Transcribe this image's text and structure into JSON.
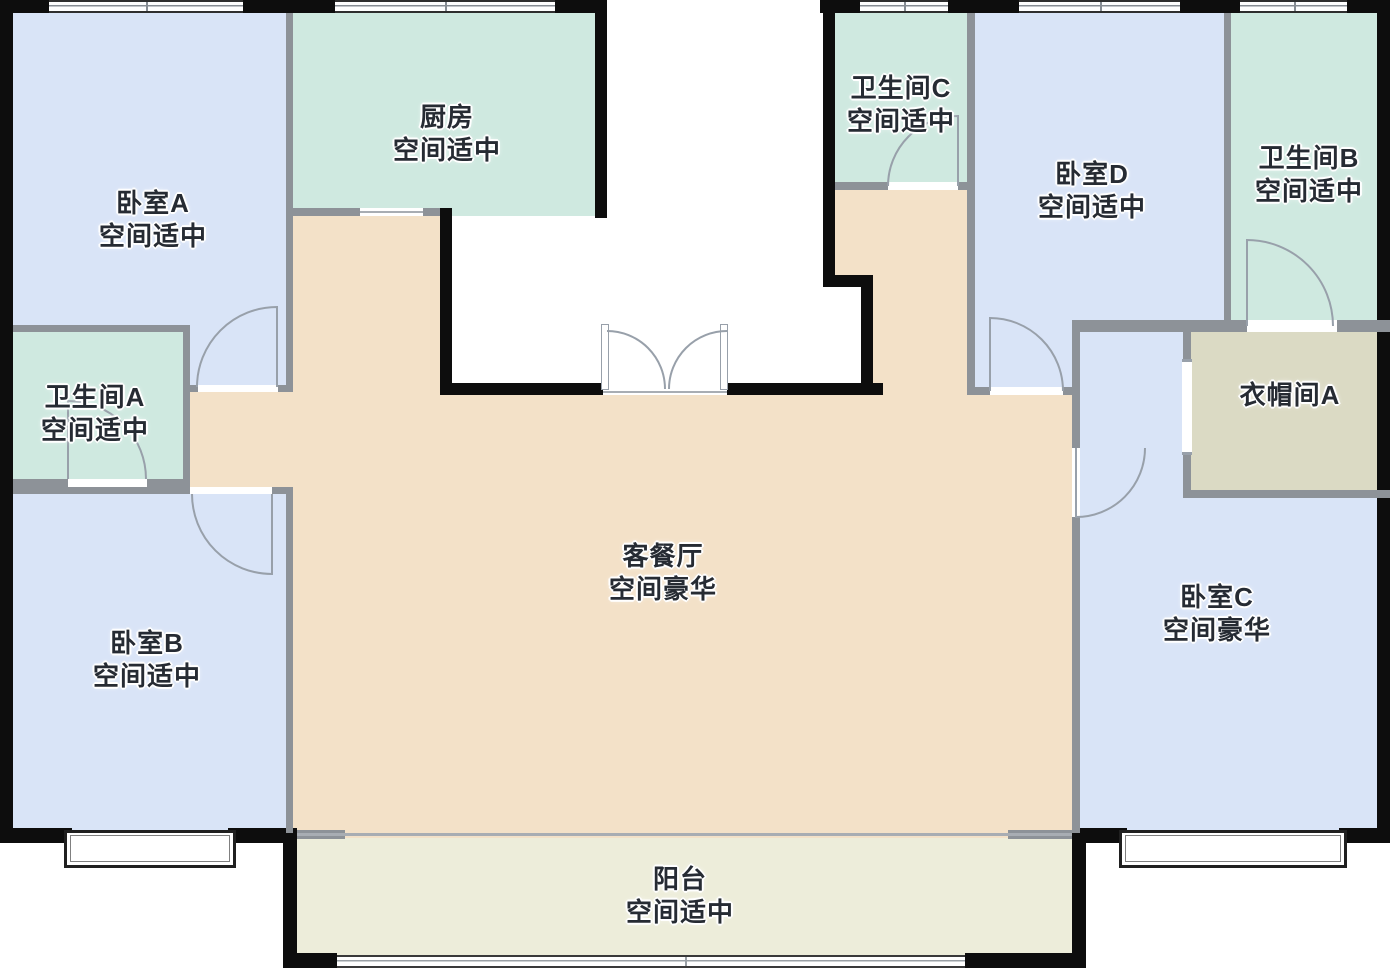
{
  "floorplan": {
    "title": "apartment-floor-plan",
    "colors": {
      "bedroom": "#d9e4f7",
      "wet": "#cfe9e0",
      "living": "#f3e1c8",
      "balcony": "#ededda",
      "closet": "#dbdac4",
      "wall_black": "#0d0d0d",
      "wall_gray": "#8d9298",
      "door_stroke": "#98a0aa",
      "label_text": "#262b33"
    },
    "rooms": [
      {
        "id": "bedroom-a",
        "lines": [
          "卧室A",
          "空间适中"
        ],
        "fill": "bedroom",
        "label": {
          "x": 153,
          "y": 187
        },
        "rects": [
          [
            13,
            13,
            280,
            379
          ]
        ]
      },
      {
        "id": "kitchen",
        "lines": [
          "厨房",
          "空间适中"
        ],
        "fill": "wet",
        "label": {
          "x": 447,
          "y": 101
        },
        "rects": [
          [
            293,
            13,
            314,
            203
          ]
        ]
      },
      {
        "id": "bath-a",
        "lines": [
          "卫生间A",
          "空间适中"
        ],
        "fill": "wet",
        "label": {
          "x": 95,
          "y": 381
        },
        "rects": [
          [
            13,
            325,
            177,
            162
          ]
        ]
      },
      {
        "id": "bedroom-b",
        "lines": [
          "卧室B",
          "空间适中"
        ],
        "fill": "bedroom",
        "label": {
          "x": 147,
          "y": 627
        },
        "rects": [
          [
            13,
            487,
            280,
            343
          ]
        ]
      },
      {
        "id": "living-dining",
        "lines": [
          "客餐厅",
          "空间豪华"
        ],
        "fill": "living",
        "label": {
          "x": 663,
          "y": 540
        },
        "rects": [
          [
            190,
            392,
            103,
            95
          ],
          [
            293,
            216,
            147,
            179
          ],
          [
            293,
            395,
            780,
            443
          ],
          [
            835,
            188,
            135,
            99
          ],
          [
            861,
            287,
            109,
            108
          ]
        ]
      },
      {
        "id": "balcony",
        "lines": [
          "阳台",
          "空间适中"
        ],
        "fill": "balcony",
        "label": {
          "x": 680,
          "y": 863
        },
        "rects": [
          [
            297,
            838,
            776,
            120
          ]
        ]
      },
      {
        "id": "bath-c",
        "lines": [
          "卫生间C",
          "空间适中"
        ],
        "fill": "wet",
        "label": {
          "x": 901,
          "y": 72
        },
        "rects": [
          [
            835,
            13,
            140,
            177
          ]
        ]
      },
      {
        "id": "bedroom-d",
        "lines": [
          "卧室D",
          "空间适中"
        ],
        "fill": "bedroom",
        "label": {
          "x": 1092,
          "y": 158
        },
        "rects": [
          [
            970,
            13,
            260,
            382
          ]
        ]
      },
      {
        "id": "bath-b",
        "lines": [
          "卫生间B",
          "空间适中"
        ],
        "fill": "wet",
        "label": {
          "x": 1309,
          "y": 142
        },
        "rects": [
          [
            1224,
            13,
            166,
            319
          ]
        ]
      },
      {
        "id": "bedroom-c",
        "lines": [
          "卧室C",
          "空间豪华"
        ],
        "fill": "bedroom",
        "label": {
          "x": 1217,
          "y": 581
        },
        "rects": [
          [
            1072,
            323,
            318,
            520
          ]
        ]
      },
      {
        "id": "closet-a",
        "lines": [
          "衣帽间A"
        ],
        "fill": "closet",
        "label": {
          "x": 1290,
          "y": 379
        },
        "rects": [
          [
            1183,
            323,
            207,
            175
          ]
        ]
      }
    ],
    "doors": [
      "bedroom-a-door",
      "bedroom-b-door",
      "bath-a-door",
      "bath-b-door",
      "bath-c-door",
      "bedroom-c-door",
      "bedroom-d-door",
      "entry-double-door",
      "kitchen-opening",
      "closet-a-opening"
    ]
  }
}
